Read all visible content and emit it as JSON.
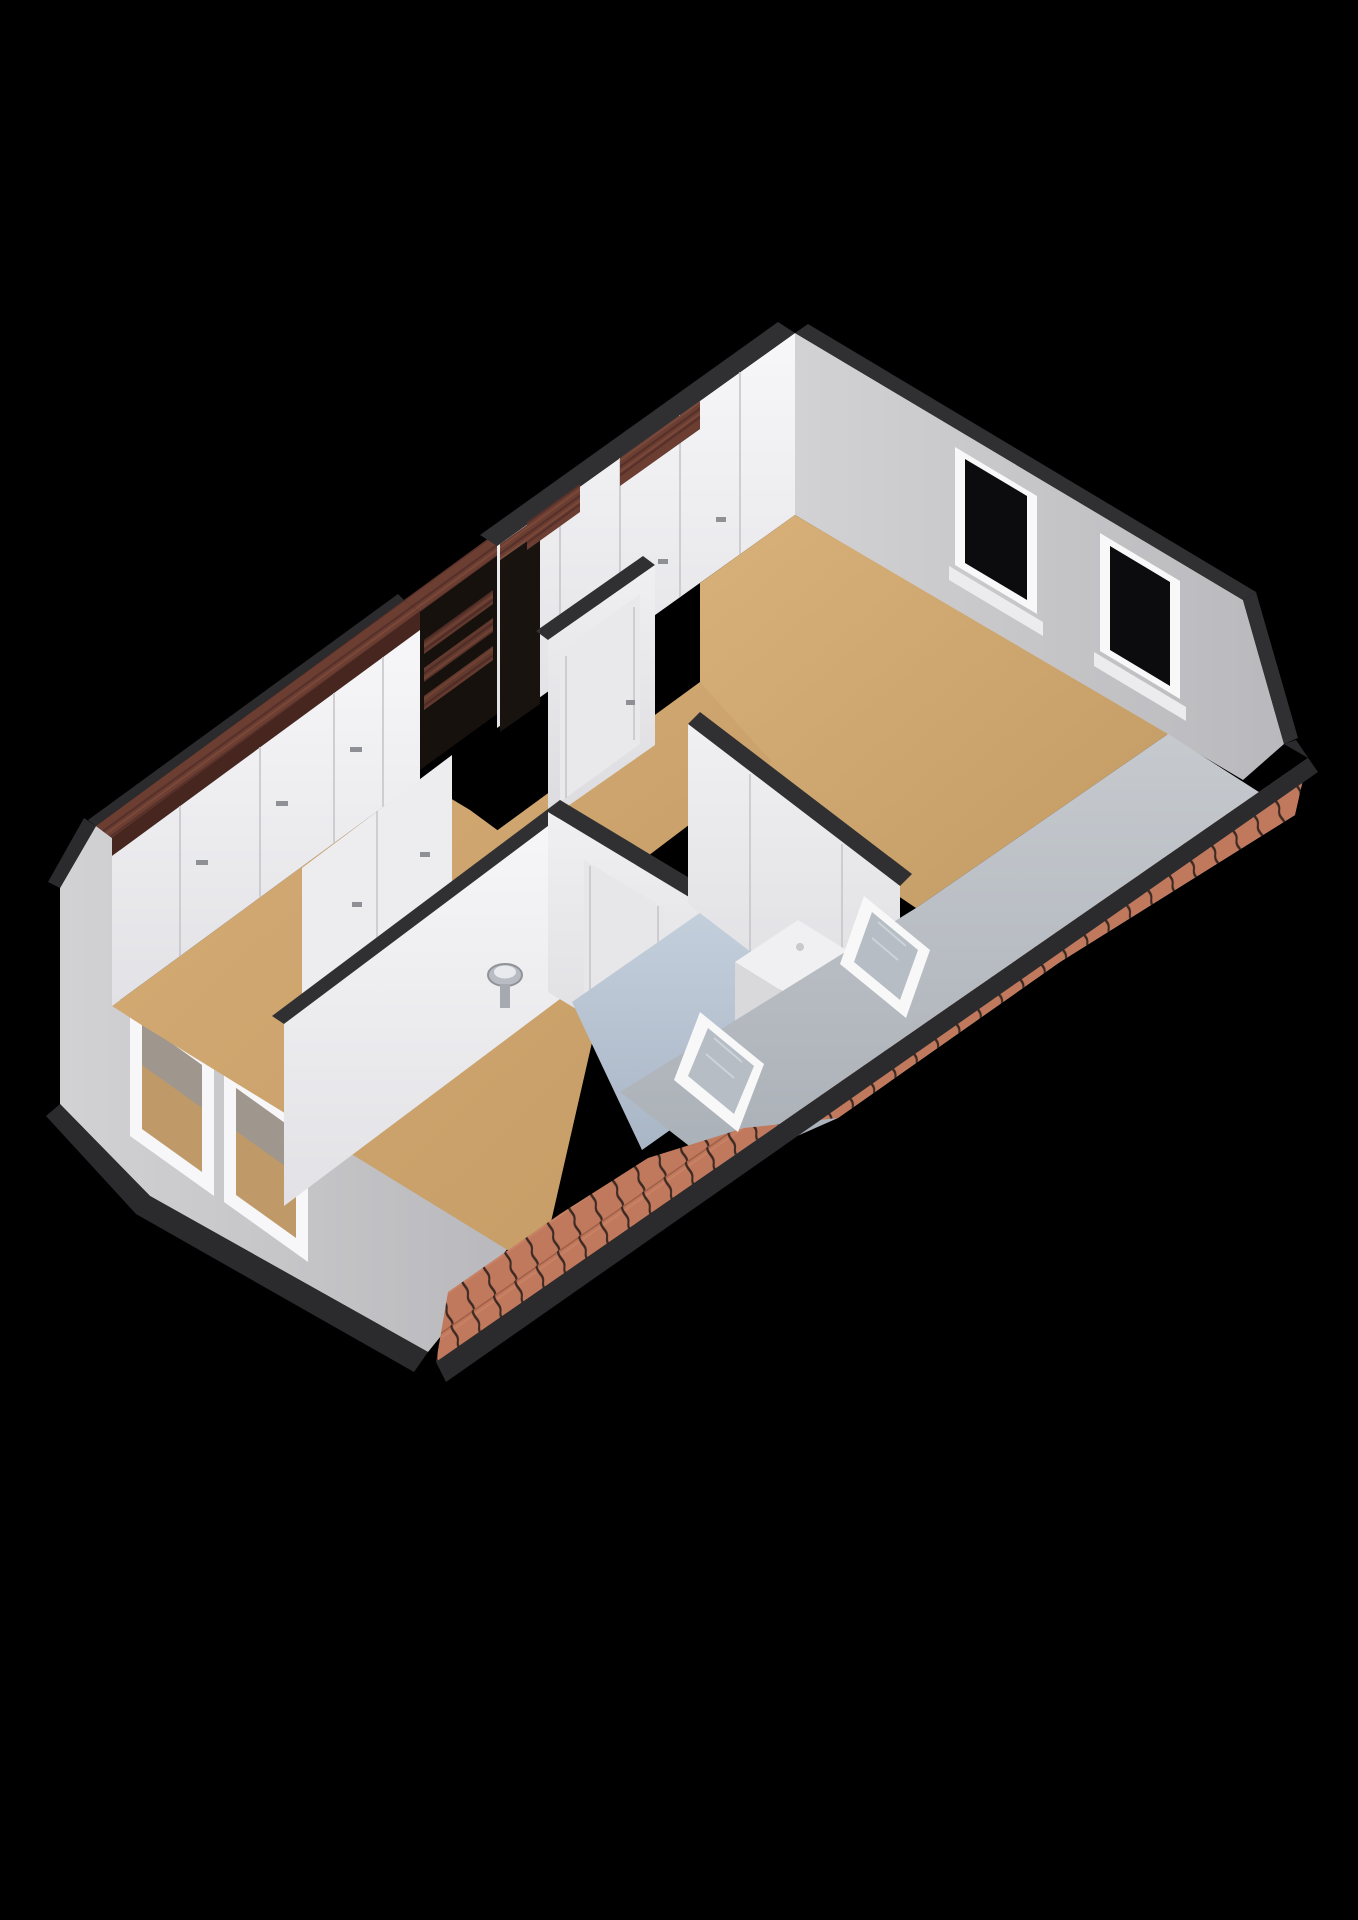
{
  "scene": {
    "title": "3d-floorplan-attic-storey",
    "view": "axonometric",
    "background": "#000000"
  },
  "palette": {
    "floor_tan": "#cda46d",
    "floor_tan_light": "#d8b079",
    "floor_bath_blue": "#b6c2d1",
    "wall_white": "#f3f3f5",
    "wall_white_shade": "#e7e7ea",
    "wall_gray_exterior": "#c6c6c8",
    "roof_slope_gray": "#b9bdc3",
    "wall_top_dark": "#303033",
    "fascia_dark": "#2b2b2e",
    "roof_tile": "#c1795d",
    "roof_tile_gap": "#3c2a23",
    "wood_beam": "#6b3e31",
    "window_glass": "#0c0c0e",
    "window_frame": "#f8f8f8",
    "skylight_glass": "#b6bdc5",
    "stair_void": "#17110d",
    "sink_gray": "#b9bcc2"
  },
  "rooms": [
    {
      "name": "bedroom-left",
      "floor": "#cda46d"
    },
    {
      "name": "hallway",
      "floor": "#cda46d"
    },
    {
      "name": "bathroom",
      "floor": "#b6c2d1"
    },
    {
      "name": "bedroom-right",
      "floor": "#cda46d"
    }
  ],
  "elements": {
    "ne_wall_windows": 2,
    "gable_windows": 2,
    "skylights": 2,
    "wardrobe_sections": 5,
    "closet_door_panels": 5,
    "stairwell": "stair-opening-with-wood-treads",
    "beam": "timber-roof-beam",
    "bathroom_fixture": "white-shower-unit",
    "sink": "wall-mounted-basin"
  }
}
